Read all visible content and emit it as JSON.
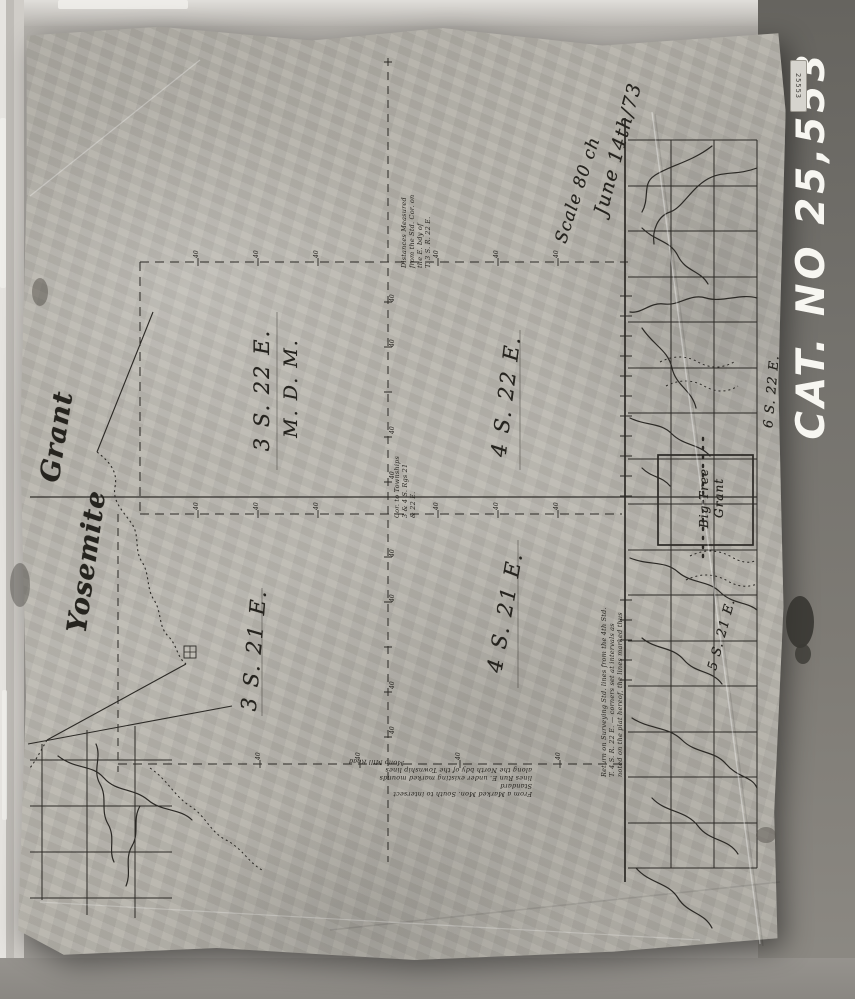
{
  "photo": {
    "catalog_label": "CAT. NO 25,553",
    "sticker_label": "25553"
  },
  "map": {
    "scale_label": "Scale 80 ch",
    "date_label": "June 14th/73",
    "tick_label": "40",
    "townships": {
      "t3s22e": "3 S. 22 E.",
      "meridian": "M. D. M.",
      "t4s22e": "4 S. 22 E.",
      "t3s21e": "3 S. 21 E.",
      "t4s21e": "4 S. 21 E.",
      "t6s22e": "6 S. 22 E.",
      "t5s21e": "5 S. 21 E."
    },
    "grants": {
      "yosemite_word1": "Yosemite",
      "yosemite_word2": "Grant",
      "big_tree_line1": "Big Tree",
      "big_tree_line2": "Grant"
    },
    "notes": {
      "top": [
        "Distances Measured",
        "from the Std. Cor. on",
        "the E. bdy of",
        "T. 3 S. R. 22 E."
      ],
      "center": [
        "Cor. to Townships",
        "3 & 4 S. Rgs 21",
        "& 22 E."
      ],
      "east": [
        "Return on Surveying Std. lines from the 4th Std.",
        "T. 4 S. R. 22 E. — corners set at intervals as",
        "noted on the plat hereof, the lines marked thus"
      ],
      "bottom": [
        "From a Marked Mon. South to intersect Standard",
        "lines Run E. under existing marked mounds",
        "along the North bdy of the Township lines"
      ],
      "road": "Mono Mill Road"
    }
  }
}
